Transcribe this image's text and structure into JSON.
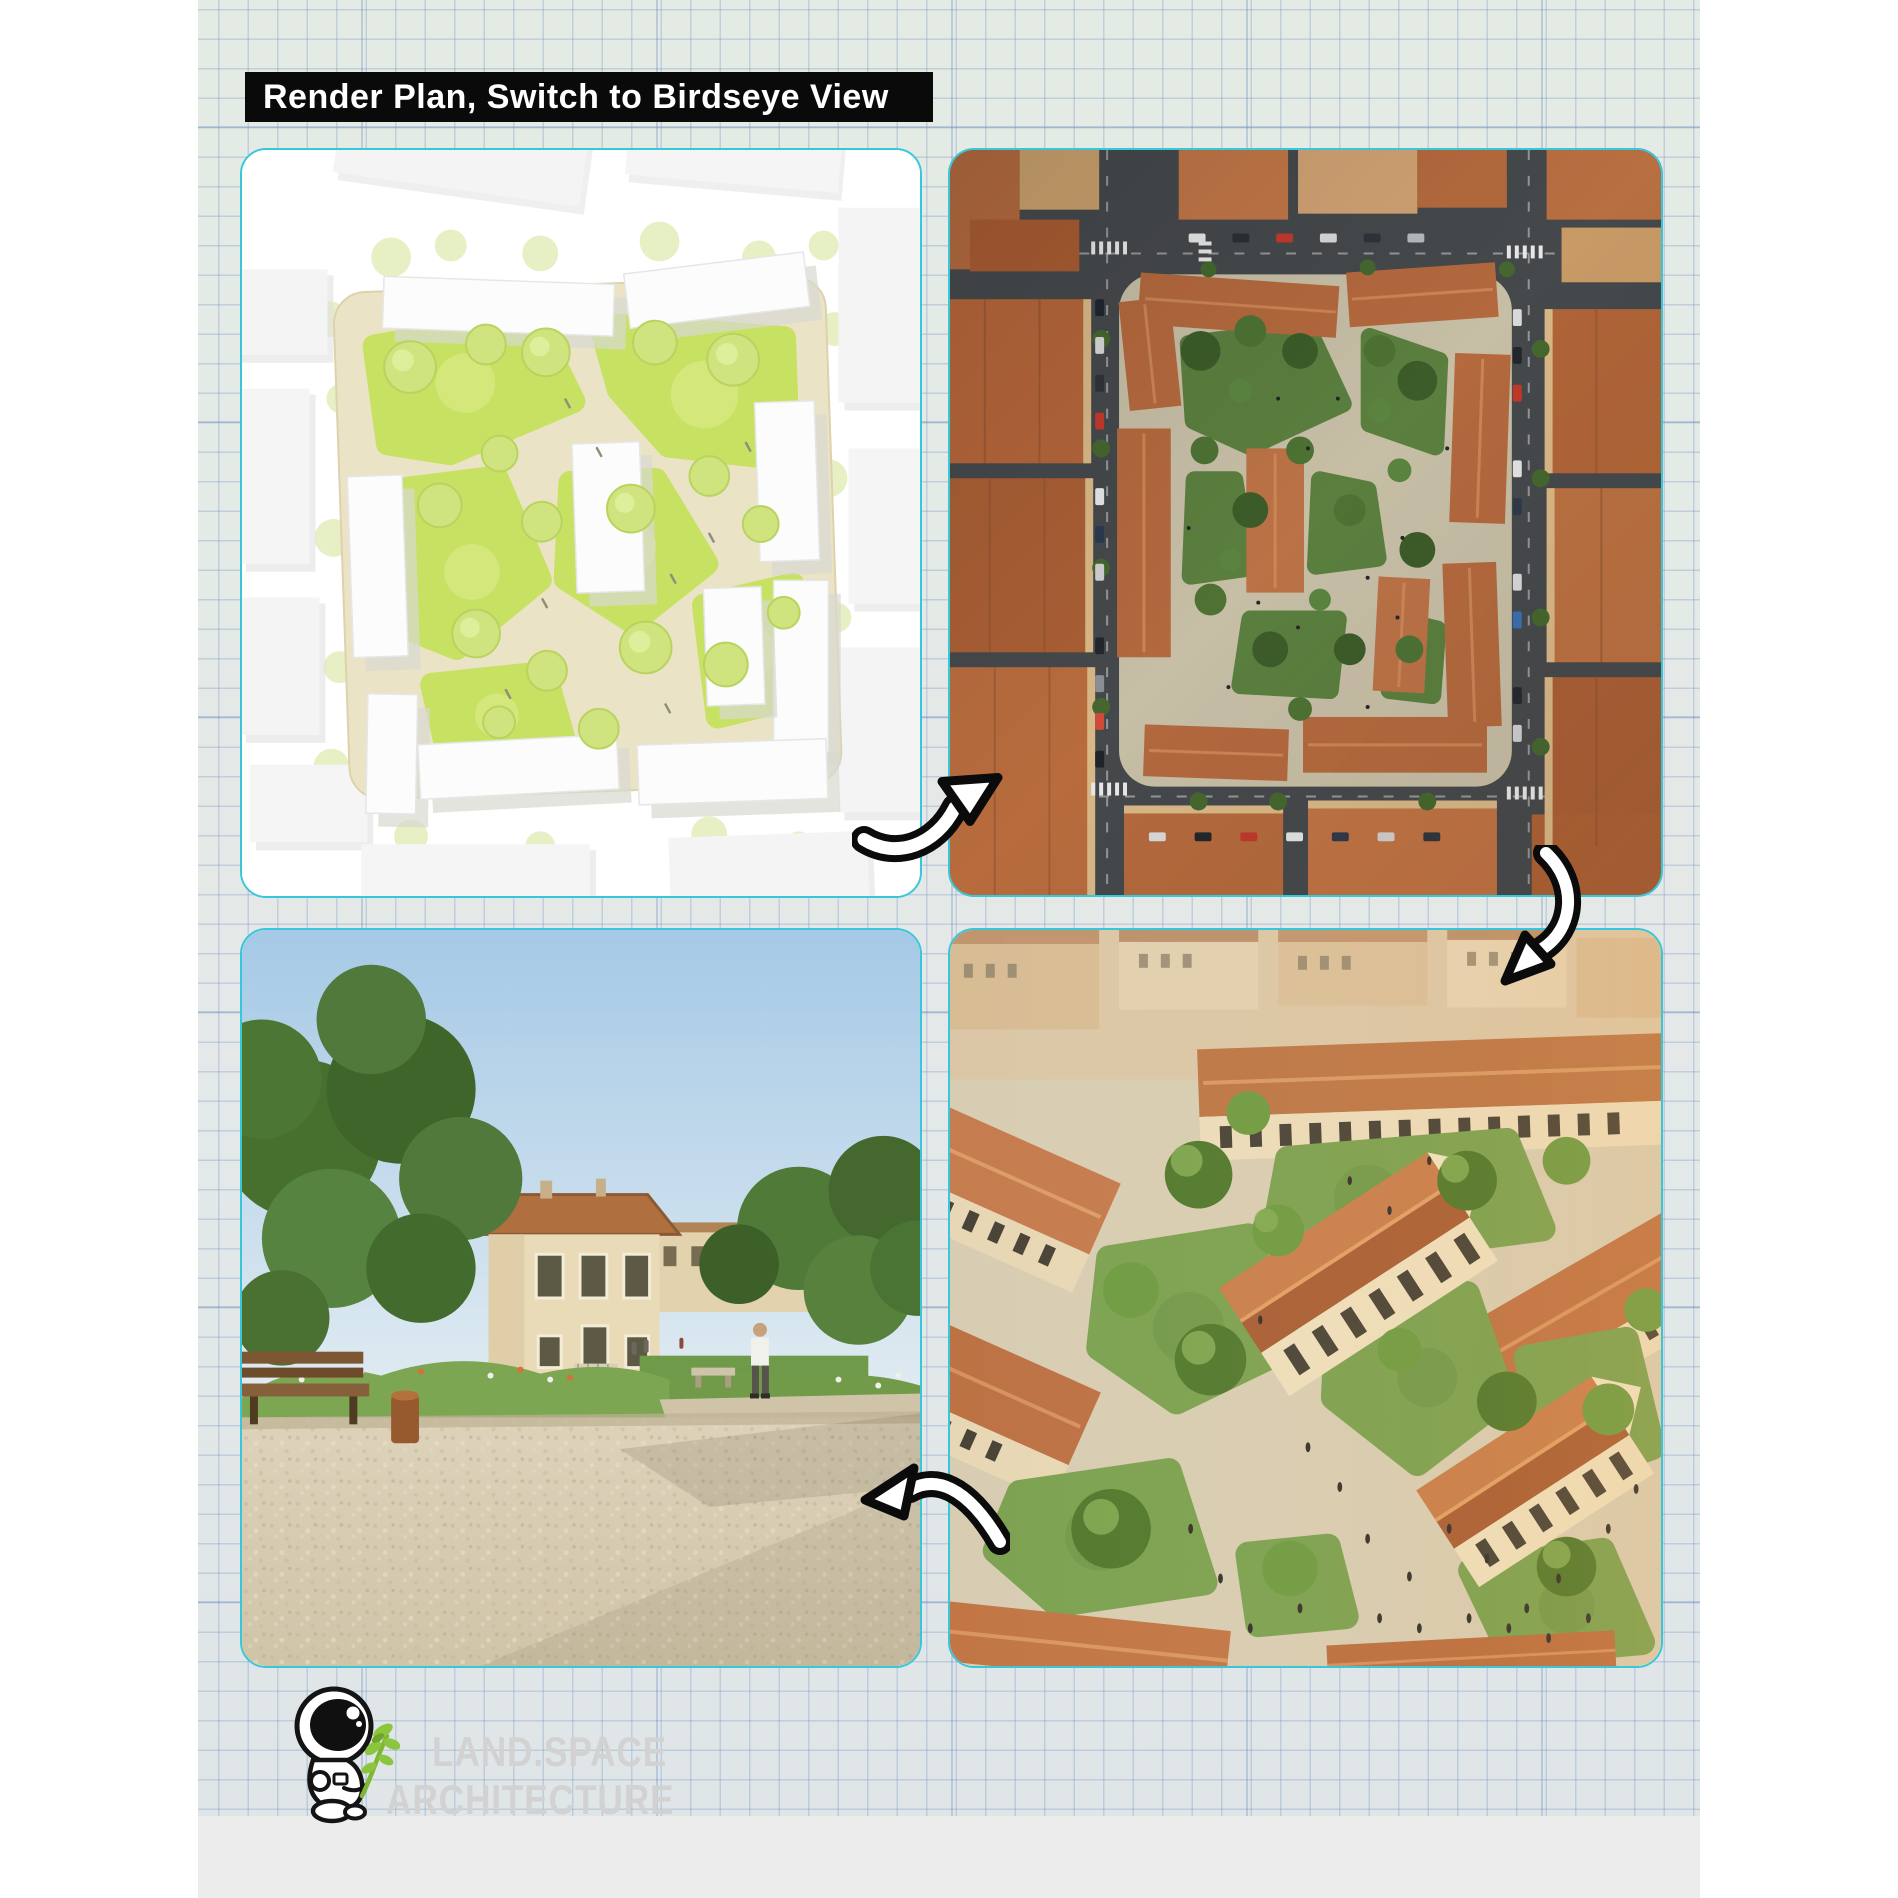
{
  "header": {
    "title": "Render Plan, Switch to Birdseye View"
  },
  "brand": {
    "line1": "LAND.SPACE",
    "line2": "ARCHITECTURE"
  },
  "panels": {
    "plan": {
      "label": "Site plan render: white buildings around a green courtyard with trees and paths"
    },
    "aerial": {
      "label": "Birdseye aerial view: city block with terracotta roofs around a green courtyard"
    },
    "photo": {
      "label": "Ground-level park photo: gravel plaza, trees and a villa with tiled roof"
    },
    "render": {
      "label": "Birdseye render: courtyard with lawns, trees and gable-roof houses"
    }
  },
  "icons": {
    "arrow_plan_to_aerial": "curved-arrow-up-right-icon",
    "arrow_aerial_to_render": "curved-arrow-down-left-icon",
    "arrow_render_to_photo": "curved-arrow-left-icon",
    "logo_mascot": "astronaut-with-leaf-icon"
  },
  "colors": {
    "card_border": "#38c7da",
    "banner_bg": "#0a0a0a",
    "banner_text": "#ffffff",
    "paper": "#e9ece8",
    "grid_line": "#7d9bc8",
    "watermark": "#d2d2d2",
    "bottom_strip": "#ececec",
    "leaf_green": "#8cc63e"
  }
}
